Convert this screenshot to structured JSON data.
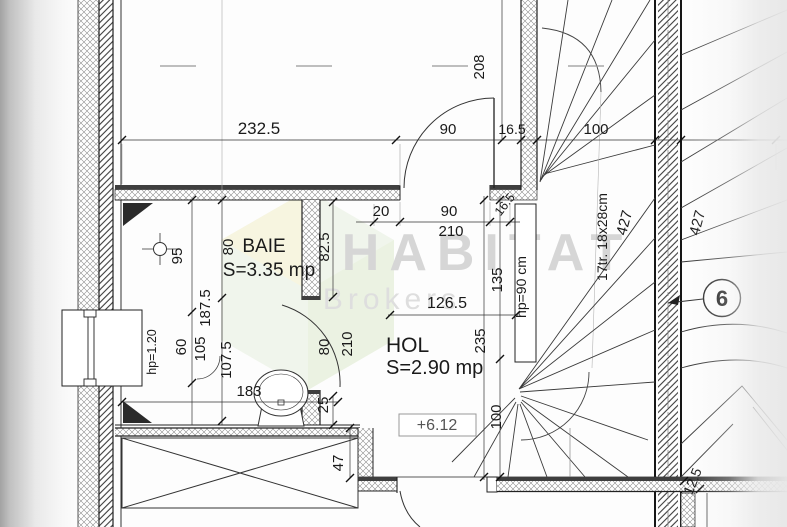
{
  "watermark": {
    "title": "HABITAT",
    "subtitle": "Brokers"
  },
  "rooms": {
    "baie": {
      "name": "BAIE",
      "area": "S=3.35 mp"
    },
    "hol": {
      "name": "HOL",
      "area": "S=2.90 mp"
    }
  },
  "level_marker": {
    "value": "+6.12"
  },
  "grid_axis": {
    "label": "6"
  },
  "stair": {
    "tread_note": "17tr. 18x28cm",
    "rail_height": "hp=90 cm",
    "flight_left_len": "427",
    "flight_right_len": "427"
  },
  "window": {
    "parapet_height": "hp=1.20"
  },
  "dims": {
    "room_top_width": "232.5",
    "room_top_depth": "208",
    "door_top_width": "90",
    "wall_top_thk": "16.5",
    "stair_top_width": "100",
    "seg_20": "20",
    "door_hol_width": "90",
    "door_hol_height": "210",
    "wall_hol_thk": "16.5",
    "hol_width": "126.5",
    "hol_len_upper": "135",
    "hol_len_total": "235",
    "hol_len_lower": "100",
    "baie_95": "95",
    "baie_80": "80",
    "baie_82_5": "82.5",
    "baie_187_5": "187.5",
    "baie_107_5": "107.5",
    "baie_105": "105",
    "baie_60": "60",
    "baie_width": "183",
    "baie_25": "25",
    "door_baie_width": "80",
    "door_baie_height": "210",
    "shaft_depth": "47",
    "wall_12_5": "12.5"
  }
}
